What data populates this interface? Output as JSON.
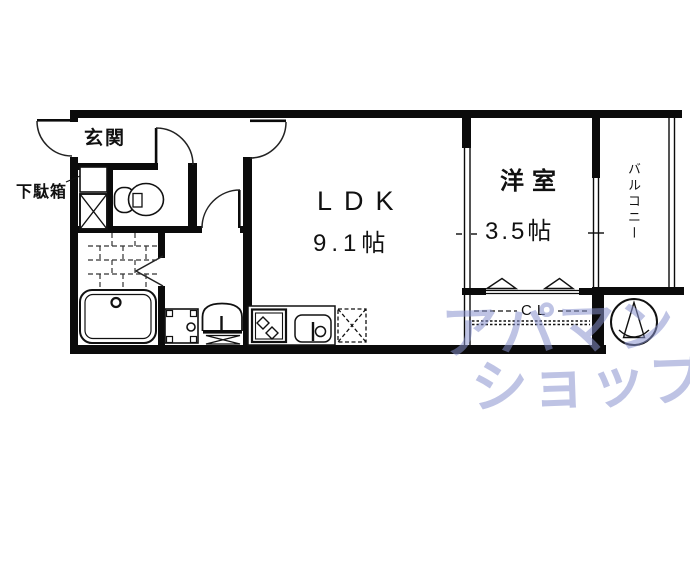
{
  "rooms": {
    "genkan": {
      "label": "玄関"
    },
    "shoe_cabinet": {
      "label": "下駄箱"
    },
    "ldk": {
      "label": "LDK",
      "area": "9.1帖"
    },
    "western_room": {
      "label": "洋室",
      "area": "3.5帖"
    },
    "balcony": {
      "label": "バルコニー"
    },
    "closet": {
      "label": "CL"
    }
  },
  "watermark": {
    "line1": "アパマン",
    "line2": "ショップ",
    "color": "#8892cd"
  },
  "symbols": {
    "compass": "north-arrow-compass"
  },
  "colors": {
    "line": "#0b0b0b",
    "background": "#ffffff"
  }
}
